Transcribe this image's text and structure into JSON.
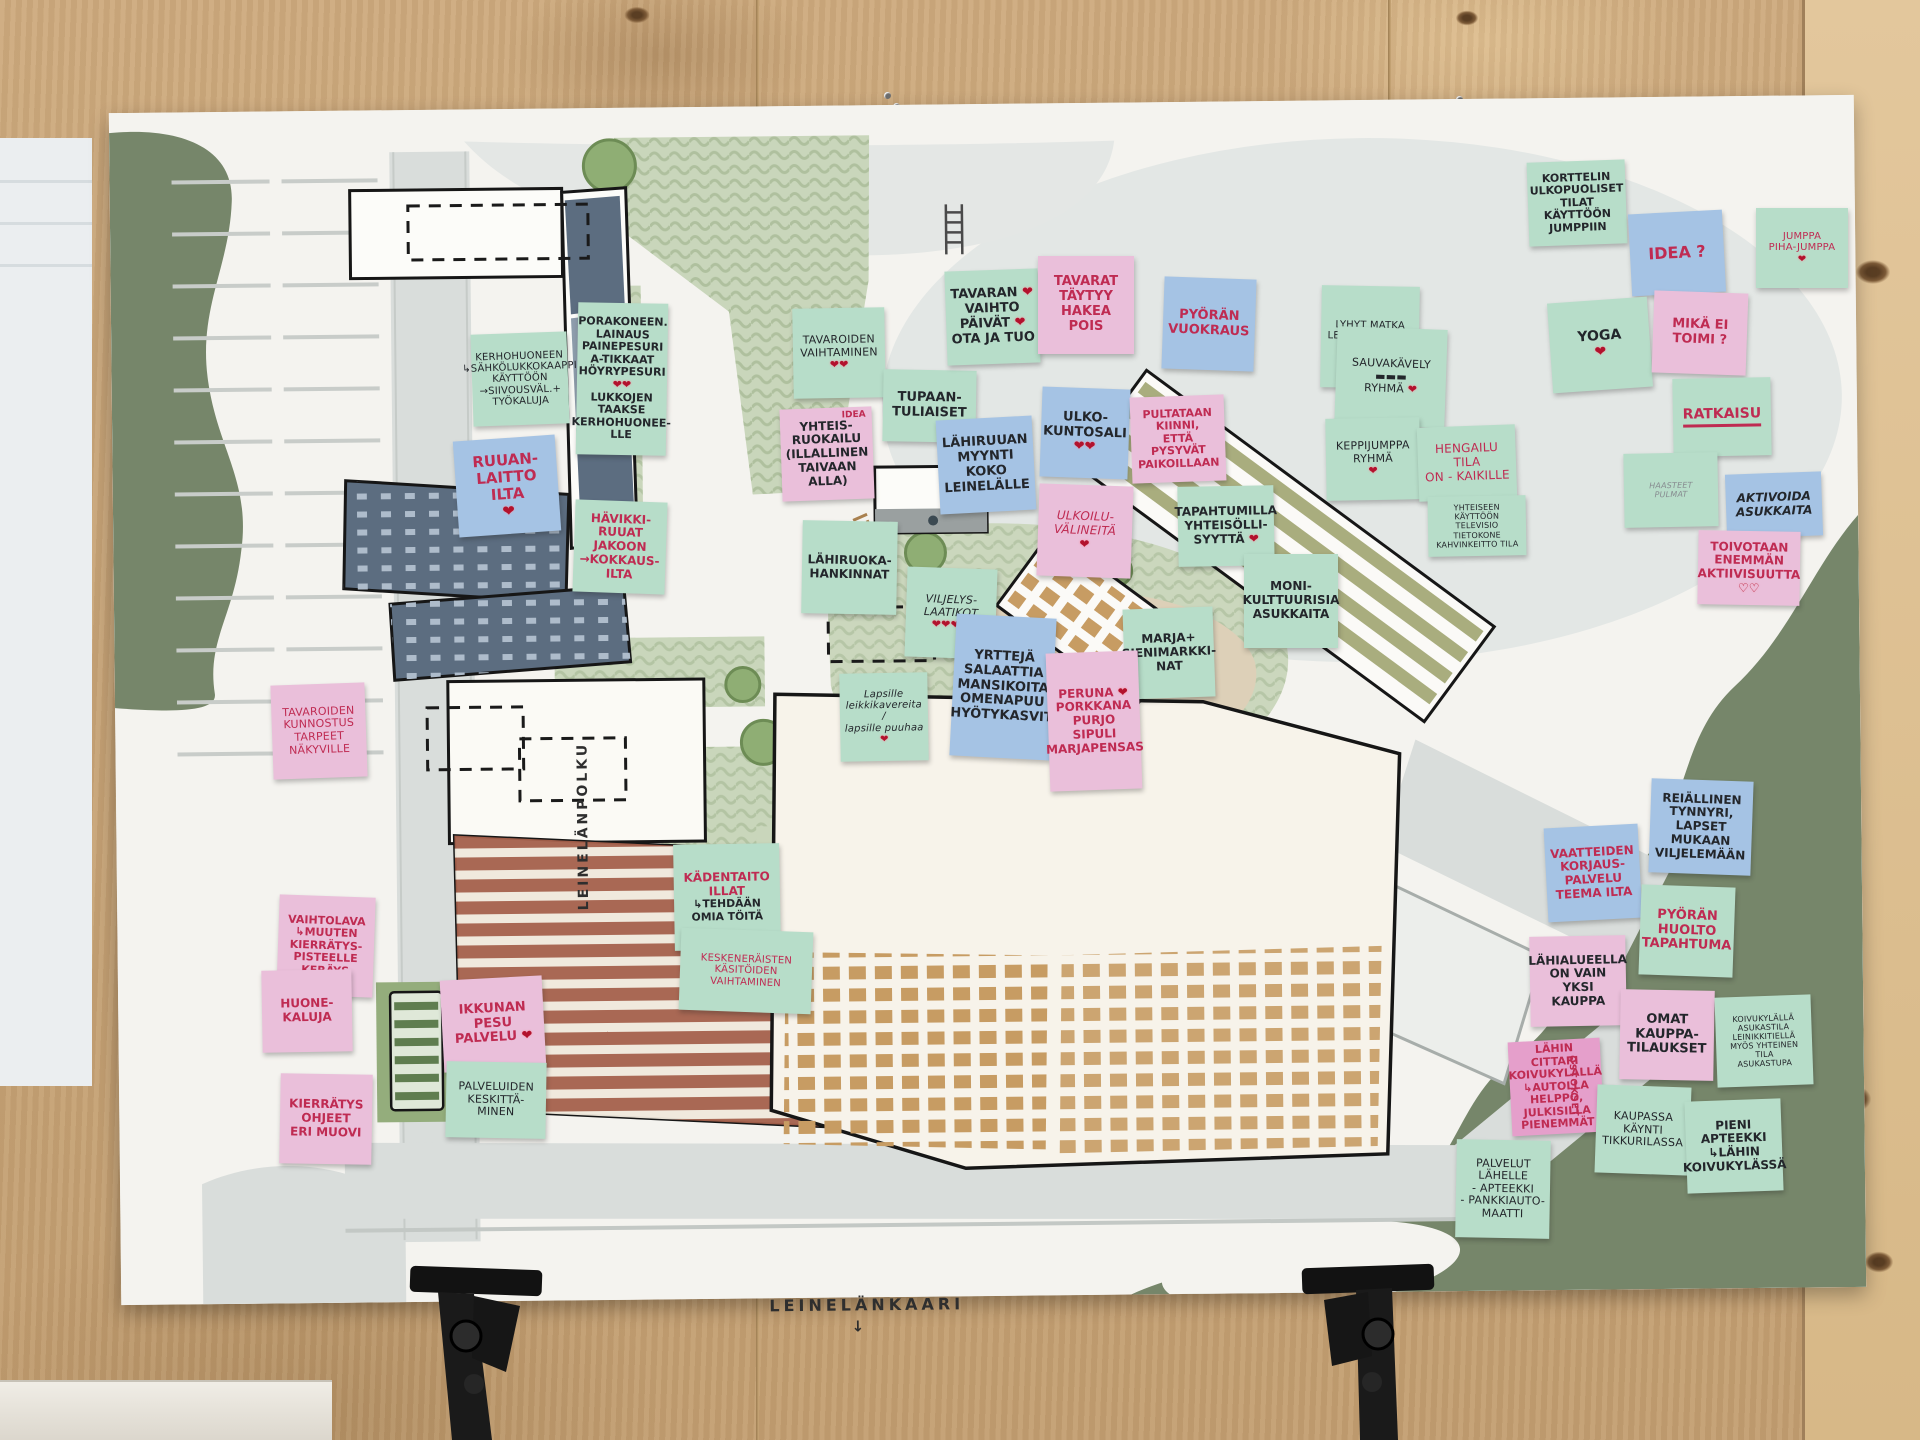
{
  "title": "Leinelä participatory planning board",
  "streets": {
    "polku": "LEINELÄNPOLKU",
    "kaari": "LEINELÄNKAARI",
    "arrow": "↓"
  },
  "palette": {
    "note_mint": "#b7ddc9",
    "note_blue": "#a5c3e4",
    "note_pink": "#eabfda",
    "note_pink_deep": "#e59fcb",
    "ink_red": "#bf2b52",
    "ink_black": "#23262b",
    "heart_red": "#b2122d",
    "board_green": "#76866a",
    "park_green": "#c9d6bb",
    "road_gray": "#d9dddb",
    "brick": "#a5604b",
    "slate": "#5c6d80",
    "window_ochre": "#c79c63",
    "wood": "#c9a77b"
  },
  "notes": [
    {
      "id": "kerhohuoneen-kaappi",
      "x": 472,
      "y": 333,
      "w": 96,
      "h": 92,
      "rot": -2,
      "bg": "mint",
      "ink": "black",
      "fs": 10,
      "pen": true,
      "lines": [
        "KERHOHUONEEN",
        "↳SÄHKÖLUKKOKAAPPI",
        "KÄYTTÖÖN",
        "→SIIVOUSVÄL.+",
        "TYÖKALUJA"
      ]
    },
    {
      "id": "porakoneen-lainaus",
      "x": 577,
      "y": 303,
      "w": 90,
      "h": 152,
      "rot": 1,
      "bg": "mint",
      "ink": "black",
      "fs": 11,
      "lines": [
        "PORAKONEEN.",
        "LAINAUS",
        "PAINEPESURI",
        "A-TIKKAAT",
        "HÖYRYPESURI ❤❤",
        "LUKKOJEN",
        "TAAKSE",
        "KERHOHUONEE-",
        "LLE"
      ]
    },
    {
      "id": "ruuanlaitto-ilta",
      "x": 456,
      "y": 438,
      "w": 102,
      "h": 96,
      "rot": -4,
      "bg": "blue",
      "ink": "red",
      "fs": 15,
      "lines": [
        "RUUAN-",
        "LAITTO",
        "ILTA",
        "❤"
      ]
    },
    {
      "id": "havikkiruuat",
      "x": 574,
      "y": 501,
      "w": 92,
      "h": 92,
      "rot": 2,
      "bg": "mint",
      "ink": "red",
      "fs": 12,
      "lines": [
        "HÄVIKKI-",
        "RUUAT",
        "JAKOON",
        "→KOKKAUS-",
        "ILTA"
      ]
    },
    {
      "id": "tavaroiden-vaihtaminen",
      "x": 793,
      "y": 308,
      "w": 92,
      "h": 90,
      "rot": -1,
      "bg": "mint",
      "ink": "black",
      "fs": 11,
      "pen": true,
      "lines": [
        "TAVAROIDEN",
        "VAIHTAMINEN",
        "❤❤"
      ]
    },
    {
      "id": "yhteisruokailu",
      "x": 781,
      "y": 408,
      "w": 92,
      "h": 92,
      "rot": -2,
      "bg": "pink",
      "ink": "black",
      "fs": 12,
      "corner": "IDEA",
      "lines": [
        "YHTEIS-",
        "RUOKAILU",
        "(ILLALLINEN",
        "TAIVAAN ALLA)"
      ]
    },
    {
      "id": "lahiruoka-hankinnat",
      "x": 802,
      "y": 521,
      "w": 95,
      "h": 93,
      "rot": 1,
      "bg": "mint",
      "ink": "black",
      "fs": 12,
      "lines": [
        "LÄHIRUOKA-",
        "HANKINNAT"
      ]
    },
    {
      "id": "tupaantuliaiset",
      "x": 883,
      "y": 370,
      "w": 93,
      "h": 72,
      "rot": 1,
      "bg": "mint",
      "ink": "black",
      "fs": 13,
      "lines": [
        "TUPAAN-",
        "TULIAISET"
      ]
    },
    {
      "id": "tavaran-vaihtopaivat",
      "x": 946,
      "y": 270,
      "w": 93,
      "h": 94,
      "rot": -2,
      "bg": "mint",
      "ink": "black",
      "fs": 13,
      "lines": [
        "TAVARAN ❤",
        "VAIHTO",
        "PÄIVÄT ❤",
        "OTA JA TUO"
      ]
    },
    {
      "id": "tavarat-taytyy-hakea",
      "x": 1038,
      "y": 256,
      "w": 96,
      "h": 98,
      "rot": 0,
      "bg": "pink",
      "ink": "red",
      "fs": 13,
      "lines": [
        "TAVARAT",
        "TÄYTYY",
        "HAKEA",
        "POIS"
      ]
    },
    {
      "id": "pyoran-vuokraus",
      "x": 1163,
      "y": 278,
      "w": 92,
      "h": 92,
      "rot": 2,
      "bg": "blue",
      "ink": "red",
      "fs": 13,
      "lines": [
        "PYÖRÄN",
        "VUOKRAUS"
      ]
    },
    {
      "id": "lahiruuan-myynti",
      "x": 938,
      "y": 418,
      "w": 96,
      "h": 94,
      "rot": -3,
      "bg": "blue",
      "ink": "black",
      "fs": 13,
      "lines": [
        "LÄHIRUUAN",
        "MYYNTI",
        "KOKO",
        "LEINELÄLLE"
      ]
    },
    {
      "id": "ulkokuntosali",
      "x": 1041,
      "y": 388,
      "w": 88,
      "h": 90,
      "rot": 2,
      "bg": "blue",
      "ink": "black",
      "fs": 13,
      "lines": [
        "ULKO-",
        "KUNTOSALI",
        "❤❤"
      ]
    },
    {
      "id": "pultataan-kiinni",
      "x": 1131,
      "y": 396,
      "w": 94,
      "h": 86,
      "rot": -2,
      "bg": "pink",
      "ink": "red",
      "fs": 11,
      "lines": [
        "PULTATAAN",
        "KIINNI,",
        "ETTÄ PYSYVÄT",
        "PAIKOILLAAN"
      ]
    },
    {
      "id": "ulkoiluvalineita",
      "x": 1038,
      "y": 485,
      "w": 94,
      "h": 92,
      "rot": 2,
      "bg": "pink",
      "ink": "red",
      "fs": 12,
      "pen": true,
      "it": true,
      "lines": [
        "ULKOILU-",
        "VÄLINEITÄ",
        "❤"
      ]
    },
    {
      "id": "tapahtumilla-yhteisollisyytta",
      "x": 1178,
      "y": 486,
      "w": 96,
      "h": 80,
      "rot": -1,
      "bg": "mint",
      "ink": "black",
      "fs": 12,
      "lines": [
        "TAPAHTUMILLA",
        "YHTEISÖLLI-",
        "SYYTTÄ ❤"
      ]
    },
    {
      "id": "monikulttuurisia",
      "x": 1244,
      "y": 554,
      "w": 94,
      "h": 94,
      "rot": 0,
      "bg": "mint",
      "ink": "black",
      "fs": 12,
      "lines": [
        "MONI-",
        "KULTTUURISIA",
        "ASUKKAITA"
      ]
    },
    {
      "id": "marja-sienimarkkinat",
      "x": 1124,
      "y": 608,
      "w": 90,
      "h": 90,
      "rot": -2,
      "bg": "mint",
      "ink": "black",
      "fs": 12,
      "lines": [
        "MARJA+",
        "SIENIMARKKI-",
        "NAT"
      ]
    },
    {
      "id": "viljelyslaatikot",
      "x": 906,
      "y": 568,
      "w": 90,
      "h": 90,
      "rot": 2,
      "bg": "mint",
      "ink": "black",
      "fs": 11,
      "pen": true,
      "it": true,
      "lines": [
        "VILJELYS-",
        "LAATIKOT",
        "❤❤❤❤"
      ]
    },
    {
      "id": "yrtteja-salaattia",
      "x": 953,
      "y": 616,
      "w": 100,
      "h": 142,
      "rot": 3,
      "bg": "blue",
      "ink": "black",
      "fs": 13,
      "lines": [
        "YRTTEJÄ",
        "SALAATTIA",
        "MANSIKOITA",
        "OMENAPUU",
        "HYÖTYKASVIT"
      ]
    },
    {
      "id": "peruna-porkkana",
      "x": 1048,
      "y": 652,
      "w": 92,
      "h": 138,
      "rot": -2,
      "bg": "pink",
      "ink": "red",
      "fs": 12,
      "lines": [
        "PERUNA ❤",
        "PORKKANA",
        "PURJO",
        "SIPULI",
        "MARJAPENSAS"
      ]
    },
    {
      "id": "lapsille-leikkikavereita",
      "x": 840,
      "y": 673,
      "w": 88,
      "h": 88,
      "rot": -1,
      "bg": "mint",
      "ink": "black",
      "fs": 10,
      "pen": true,
      "it": true,
      "lines": [
        "Lapsille",
        "leikkikavereita /",
        "lapsille puuhaa",
        "❤"
      ]
    },
    {
      "id": "lyhyt-matka-lenkkipoluille",
      "x": 1321,
      "y": 286,
      "w": 98,
      "h": 102,
      "rot": 1,
      "bg": "mint",
      "ink": "black",
      "fs": 10,
      "pen": true,
      "lines": [
        "LYHYT MATKA",
        "LENKKIPOLUILLE",
        "❤"
      ]
    },
    {
      "id": "sauvakavely-ryhma",
      "x": 1336,
      "y": 328,
      "w": 110,
      "h": 98,
      "rot": 2,
      "bg": "mint",
      "ink": "black",
      "fs": 11,
      "pen": true,
      "lines": [
        "SAUVAKÄVELY",
        "▬▬▬",
        "RYHMÄ ❤"
      ]
    },
    {
      "id": "keppijumppa-ryhma",
      "x": 1326,
      "y": 418,
      "w": 94,
      "h": 82,
      "rot": -1,
      "bg": "mint",
      "ink": "black",
      "fs": 11,
      "pen": true,
      "lines": [
        "KEPPIJUMPPA",
        "RYHMÄ",
        "❤"
      ]
    },
    {
      "id": "hengailutila",
      "x": 1418,
      "y": 426,
      "w": 98,
      "h": 74,
      "rot": -2,
      "bg": "mint",
      "ink": "red",
      "fs": 12,
      "pen": true,
      "lines": [
        "HENGAILU",
        "TILA",
        "ON - KAIKILLE"
      ]
    },
    {
      "id": "yhteiseen-kayttoon",
      "x": 1428,
      "y": 496,
      "w": 98,
      "h": 60,
      "rot": -1,
      "bg": "mint",
      "ink": "black",
      "fs": 8,
      "pen": true,
      "lines": [
        "YHTEISEEN KÄYTTÖÖN",
        "TELEVISIO",
        "TIETOKONE",
        "KAHVINKEITTO TILA"
      ]
    },
    {
      "id": "korttelin-ulkopuoliset",
      "x": 1528,
      "y": 161,
      "w": 98,
      "h": 84,
      "rot": -2,
      "bg": "mint",
      "ink": "black",
      "fs": 11,
      "lines": [
        "KORTTELIN",
        "ULKOPUOLISET",
        "TILAT",
        "KÄYTTÖÖN",
        "JUMPPIIN"
      ]
    },
    {
      "id": "idea-kysymys",
      "x": 1630,
      "y": 212,
      "w": 94,
      "h": 82,
      "rot": -3,
      "bg": "blue",
      "ink": "red",
      "fs": 16,
      "lines": [
        "IDEA ?"
      ]
    },
    {
      "id": "jumppa-pihajumppa",
      "x": 1756,
      "y": 208,
      "w": 92,
      "h": 80,
      "rot": 0,
      "bg": "mint",
      "ink": "red",
      "fs": 10,
      "pen": true,
      "lines": [
        "JUMPPA",
        "PIHA-JUMPPA",
        "❤"
      ]
    },
    {
      "id": "yoga",
      "x": 1550,
      "y": 300,
      "w": 100,
      "h": 90,
      "rot": -4,
      "bg": "mint",
      "ink": "black",
      "fs": 14,
      "lines": [
        "YOGA",
        "❤"
      ]
    },
    {
      "id": "mika-ei-toimi",
      "x": 1653,
      "y": 292,
      "w": 94,
      "h": 82,
      "rot": 2,
      "bg": "pink",
      "ink": "red",
      "fs": 13,
      "lines": [
        "MIKÄ EI",
        "TOIMI ?"
      ]
    },
    {
      "id": "ratkaisu",
      "x": 1673,
      "y": 378,
      "w": 98,
      "h": 78,
      "rot": -1,
      "bg": "mint",
      "ink": "red",
      "fs": 14,
      "underline": true,
      "lines": [
        "RATKAISU"
      ]
    },
    {
      "id": "haasteet-pulmat",
      "x": 1624,
      "y": 453,
      "w": 94,
      "h": 74,
      "rot": -1,
      "bg": "mint",
      "ink": "black",
      "fs": 8,
      "pen": true,
      "it": true,
      "faint": true,
      "lines": [
        "HAASTEET",
        "PULMAT"
      ]
    },
    {
      "id": "aktivoida-asukkaita",
      "x": 1726,
      "y": 473,
      "w": 96,
      "h": 64,
      "rot": -2,
      "bg": "blue",
      "ink": "black",
      "fs": 12,
      "it": true,
      "lines": [
        "AKTIVOIDA",
        "ASUKKAITA"
      ]
    },
    {
      "id": "toivotaan-aktiivisuutta",
      "x": 1698,
      "y": 531,
      "w": 102,
      "h": 74,
      "rot": 1,
      "bg": "pink",
      "ink": "red",
      "fs": 12,
      "lines": [
        "TOIVOTAAN",
        "ENEMMÄN",
        "AKTIIVISUUTTA",
        "♡♡"
      ]
    },
    {
      "id": "reiallinen-tynnyri",
      "x": 1650,
      "y": 780,
      "w": 102,
      "h": 94,
      "rot": 2,
      "bg": "blue",
      "ink": "black",
      "fs": 12,
      "lines": [
        "REIÄLLINEN",
        "TYNNYRI,",
        "LAPSET",
        "MUKAAN",
        "VILJELEMÄÄN"
      ]
    },
    {
      "id": "vaatteiden-korjauspalvelu",
      "x": 1546,
      "y": 826,
      "w": 94,
      "h": 94,
      "rot": -3,
      "bg": "blue",
      "ink": "red",
      "fs": 12,
      "lines": [
        "VAATTEIDEN",
        "KORJAUS-",
        "PALVELU",
        "TEEMA ILTA"
      ]
    },
    {
      "id": "pyoran-huolto",
      "x": 1640,
      "y": 886,
      "w": 94,
      "h": 90,
      "rot": 2,
      "bg": "mint",
      "ink": "red",
      "fs": 13,
      "lines": [
        "PYÖRÄN",
        "HUOLTO",
        "TAPAHTUMA"
      ]
    },
    {
      "id": "lahialueella-yksi-kauppa",
      "x": 1530,
      "y": 936,
      "w": 96,
      "h": 90,
      "rot": -1,
      "bg": "pink",
      "ink": "black",
      "fs": 12,
      "lines": [
        "LÄHIALUEELLA",
        "ON VAIN",
        "YKSI KAUPPA"
      ]
    },
    {
      "id": "omat-kauppatilaukset",
      "x": 1620,
      "y": 990,
      "w": 94,
      "h": 90,
      "rot": 1,
      "bg": "pink",
      "ink": "black",
      "fs": 13,
      "lines": [
        "OMAT",
        "KAUPPA-",
        "TILAUKSET"
      ]
    },
    {
      "id": "koivukylalla-asukastila",
      "x": 1716,
      "y": 996,
      "w": 96,
      "h": 90,
      "rot": -2,
      "bg": "mint",
      "ink": "black",
      "fs": 8,
      "pen": true,
      "lines": [
        "KOIVUKYLÄLLÄ",
        "ASUKASTILA",
        "LEINIKKITIELLÄ",
        "MYÖS YHTEINEN TILA",
        "ASUKASTUPA"
      ]
    },
    {
      "id": "lahin-cittari",
      "x": 1510,
      "y": 1040,
      "w": 92,
      "h": 94,
      "rot": -3,
      "bg": "pinkDeep",
      "ink": "red",
      "fs": 11,
      "vert": "OSTOKSET",
      "lines": [
        "LÄHIN",
        "CITTARI",
        "KOIVUKYLÄLLÄ",
        "↳AUTOLLA",
        "HELPPO,",
        "JULKISILLA",
        "PIENEMMÄT"
      ]
    },
    {
      "id": "kaupassa-kaynti",
      "x": 1596,
      "y": 1086,
      "w": 94,
      "h": 88,
      "rot": 2,
      "bg": "mint",
      "ink": "black",
      "fs": 11,
      "pen": true,
      "lines": [
        "KAUPASSA",
        "KÄYNTI",
        "TIKKURILASSA"
      ]
    },
    {
      "id": "pieni-apteekki",
      "x": 1686,
      "y": 1100,
      "w": 96,
      "h": 92,
      "rot": -2,
      "bg": "mint",
      "ink": "black",
      "fs": 12,
      "lines": [
        "PIENI",
        "APTEEKKI",
        "↳LÄHIN",
        "KOIVUKYLÄSSÄ"
      ]
    },
    {
      "id": "palvelut-lahelle",
      "x": 1456,
      "y": 1140,
      "w": 94,
      "h": 98,
      "rot": 1,
      "bg": "mint",
      "ink": "black",
      "fs": 11,
      "pen": true,
      "lines": [
        "PALVELUT",
        "LÄHELLE",
        "- APTEEKKI",
        "- PANKKIAUTO-",
        "MAATTI"
      ]
    },
    {
      "id": "tavaroiden-kunnostus",
      "x": 272,
      "y": 684,
      "w": 94,
      "h": 94,
      "rot": -2,
      "bg": "pink",
      "ink": "red",
      "fs": 11,
      "pen": true,
      "lines": [
        "TAVAROIDEN",
        "KUNNOSTUS",
        "TARPEET",
        "NÄKYVILLE"
      ]
    },
    {
      "id": "vaihtolava",
      "x": 278,
      "y": 896,
      "w": 96,
      "h": 100,
      "rot": 2,
      "bg": "pink",
      "ink": "red",
      "fs": 11,
      "lines": [
        "VAIHTOLAVA",
        "↳MUUTEN",
        "KIERRÄTYS-",
        "PISTEELLE",
        "KERÄYS"
      ]
    },
    {
      "id": "huonekaluja",
      "x": 262,
      "y": 970,
      "w": 90,
      "h": 82,
      "rot": -1,
      "bg": "pink",
      "ink": "red",
      "fs": 12,
      "lines": [
        "HUONE-",
        "KALUJA"
      ]
    },
    {
      "id": "kierratysohjeet",
      "x": 280,
      "y": 1074,
      "w": 92,
      "h": 90,
      "rot": 1,
      "bg": "pink",
      "ink": "red",
      "fs": 12,
      "lines": [
        "KIERRÄTYS",
        "OHJEET",
        "ERI MUOVI"
      ]
    },
    {
      "id": "ikkunanpesu",
      "x": 442,
      "y": 978,
      "w": 102,
      "h": 92,
      "rot": -3,
      "bg": "pink",
      "ink": "red",
      "fs": 13,
      "lines": [
        "IKKUNAN",
        "PESU",
        "PALVELU ❤"
      ]
    },
    {
      "id": "palveluiden-keskittaminen",
      "x": 446,
      "y": 1062,
      "w": 100,
      "h": 76,
      "rot": 1,
      "bg": "mint",
      "ink": "black",
      "fs": 11,
      "pen": true,
      "lines": [
        "PALVELUIDEN",
        "KESKITTÄ-",
        "MINEN"
      ]
    },
    {
      "id": "kadentaitoillat",
      "x": 674,
      "y": 844,
      "w": 106,
      "h": 106,
      "rot": -1,
      "bg": "mint",
      "ink": "red",
      "fs": 12,
      "lines": [
        "KÄDENTAITO",
        "ILLAT"
      ],
      "lines2": [
        "↳TEHDÄÄN",
        "OMIA TÖITÄ"
      ]
    },
    {
      "id": "keskeneraisten-kasitoiden",
      "x": 680,
      "y": 930,
      "w": 132,
      "h": 82,
      "rot": 2,
      "bg": "mint",
      "ink": "red",
      "fs": 10,
      "pen": true,
      "lines": [
        "KESKENERÄISTEN",
        "KÄSITÖIDEN",
        "VAIHTAMINEN"
      ]
    }
  ]
}
